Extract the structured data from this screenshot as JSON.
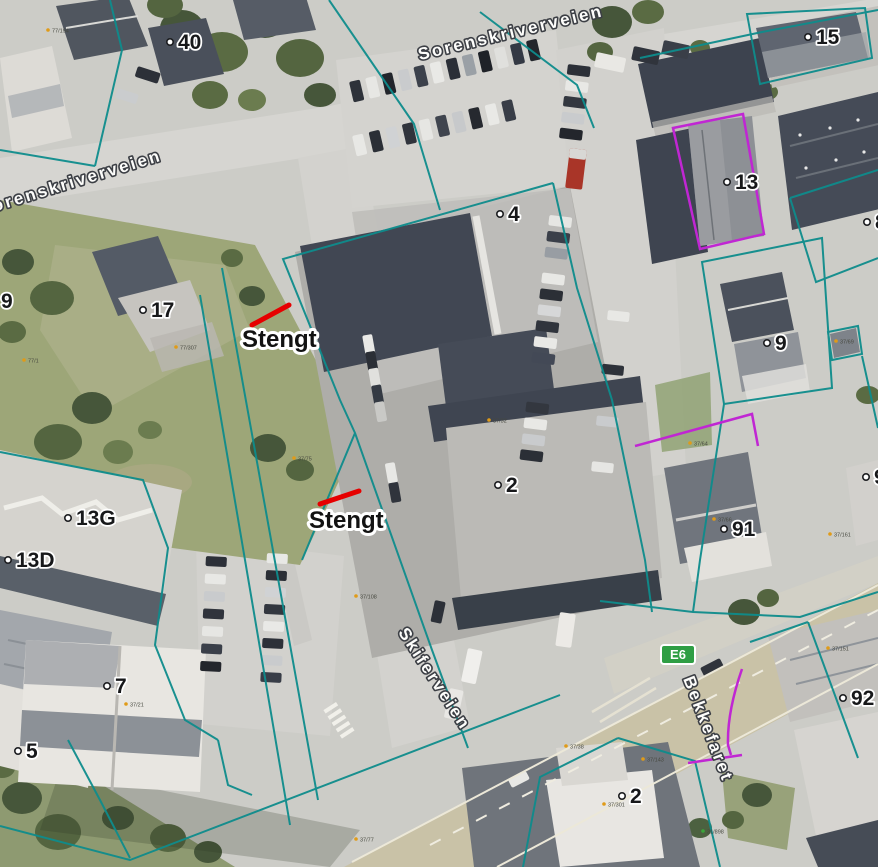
{
  "map": {
    "street_labels": [
      {
        "text": "Sorenskriverveien"
      },
      {
        "text": "Sorenskriverveien"
      },
      {
        "text": "Skiferveien"
      },
      {
        "text": "Bekkefaret"
      }
    ],
    "closures": [
      {
        "text": "Stengt"
      },
      {
        "text": "Stengt"
      }
    ],
    "route_badge": {
      "text": "E6"
    },
    "addresses": [
      {
        "label": "40"
      },
      {
        "label": "15"
      },
      {
        "label": "13"
      },
      {
        "label": "4"
      },
      {
        "label": "17"
      },
      {
        "label": "9"
      },
      {
        "label": "13G"
      },
      {
        "label": "13D"
      },
      {
        "label": "2"
      },
      {
        "label": "9"
      },
      {
        "label": "91"
      },
      {
        "label": "8"
      },
      {
        "label": "9"
      },
      {
        "label": "92"
      },
      {
        "label": "2"
      },
      {
        "label": "7"
      },
      {
        "label": "5"
      }
    ],
    "parcel_codes": [
      {
        "code": "77/194"
      },
      {
        "code": "77/1"
      },
      {
        "code": "77/307"
      },
      {
        "code": "37/75"
      },
      {
        "code": "37/108"
      },
      {
        "code": "37/32"
      },
      {
        "code": "37/64"
      },
      {
        "code": "37/69"
      },
      {
        "code": "37/66"
      },
      {
        "code": "37/143"
      },
      {
        "code": "37/151"
      },
      {
        "code": "37/38"
      },
      {
        "code": "37/301"
      },
      {
        "code": "37/77"
      },
      {
        "code": "37/21"
      },
      {
        "code": "37/161"
      },
      {
        "code": "31/898"
      }
    ],
    "colors": {
      "boundary_teal": "#0e8c8c",
      "parcel_purple": "#c026d3",
      "closure_red": "#e60000",
      "badge_green": "#2f9e44"
    }
  }
}
